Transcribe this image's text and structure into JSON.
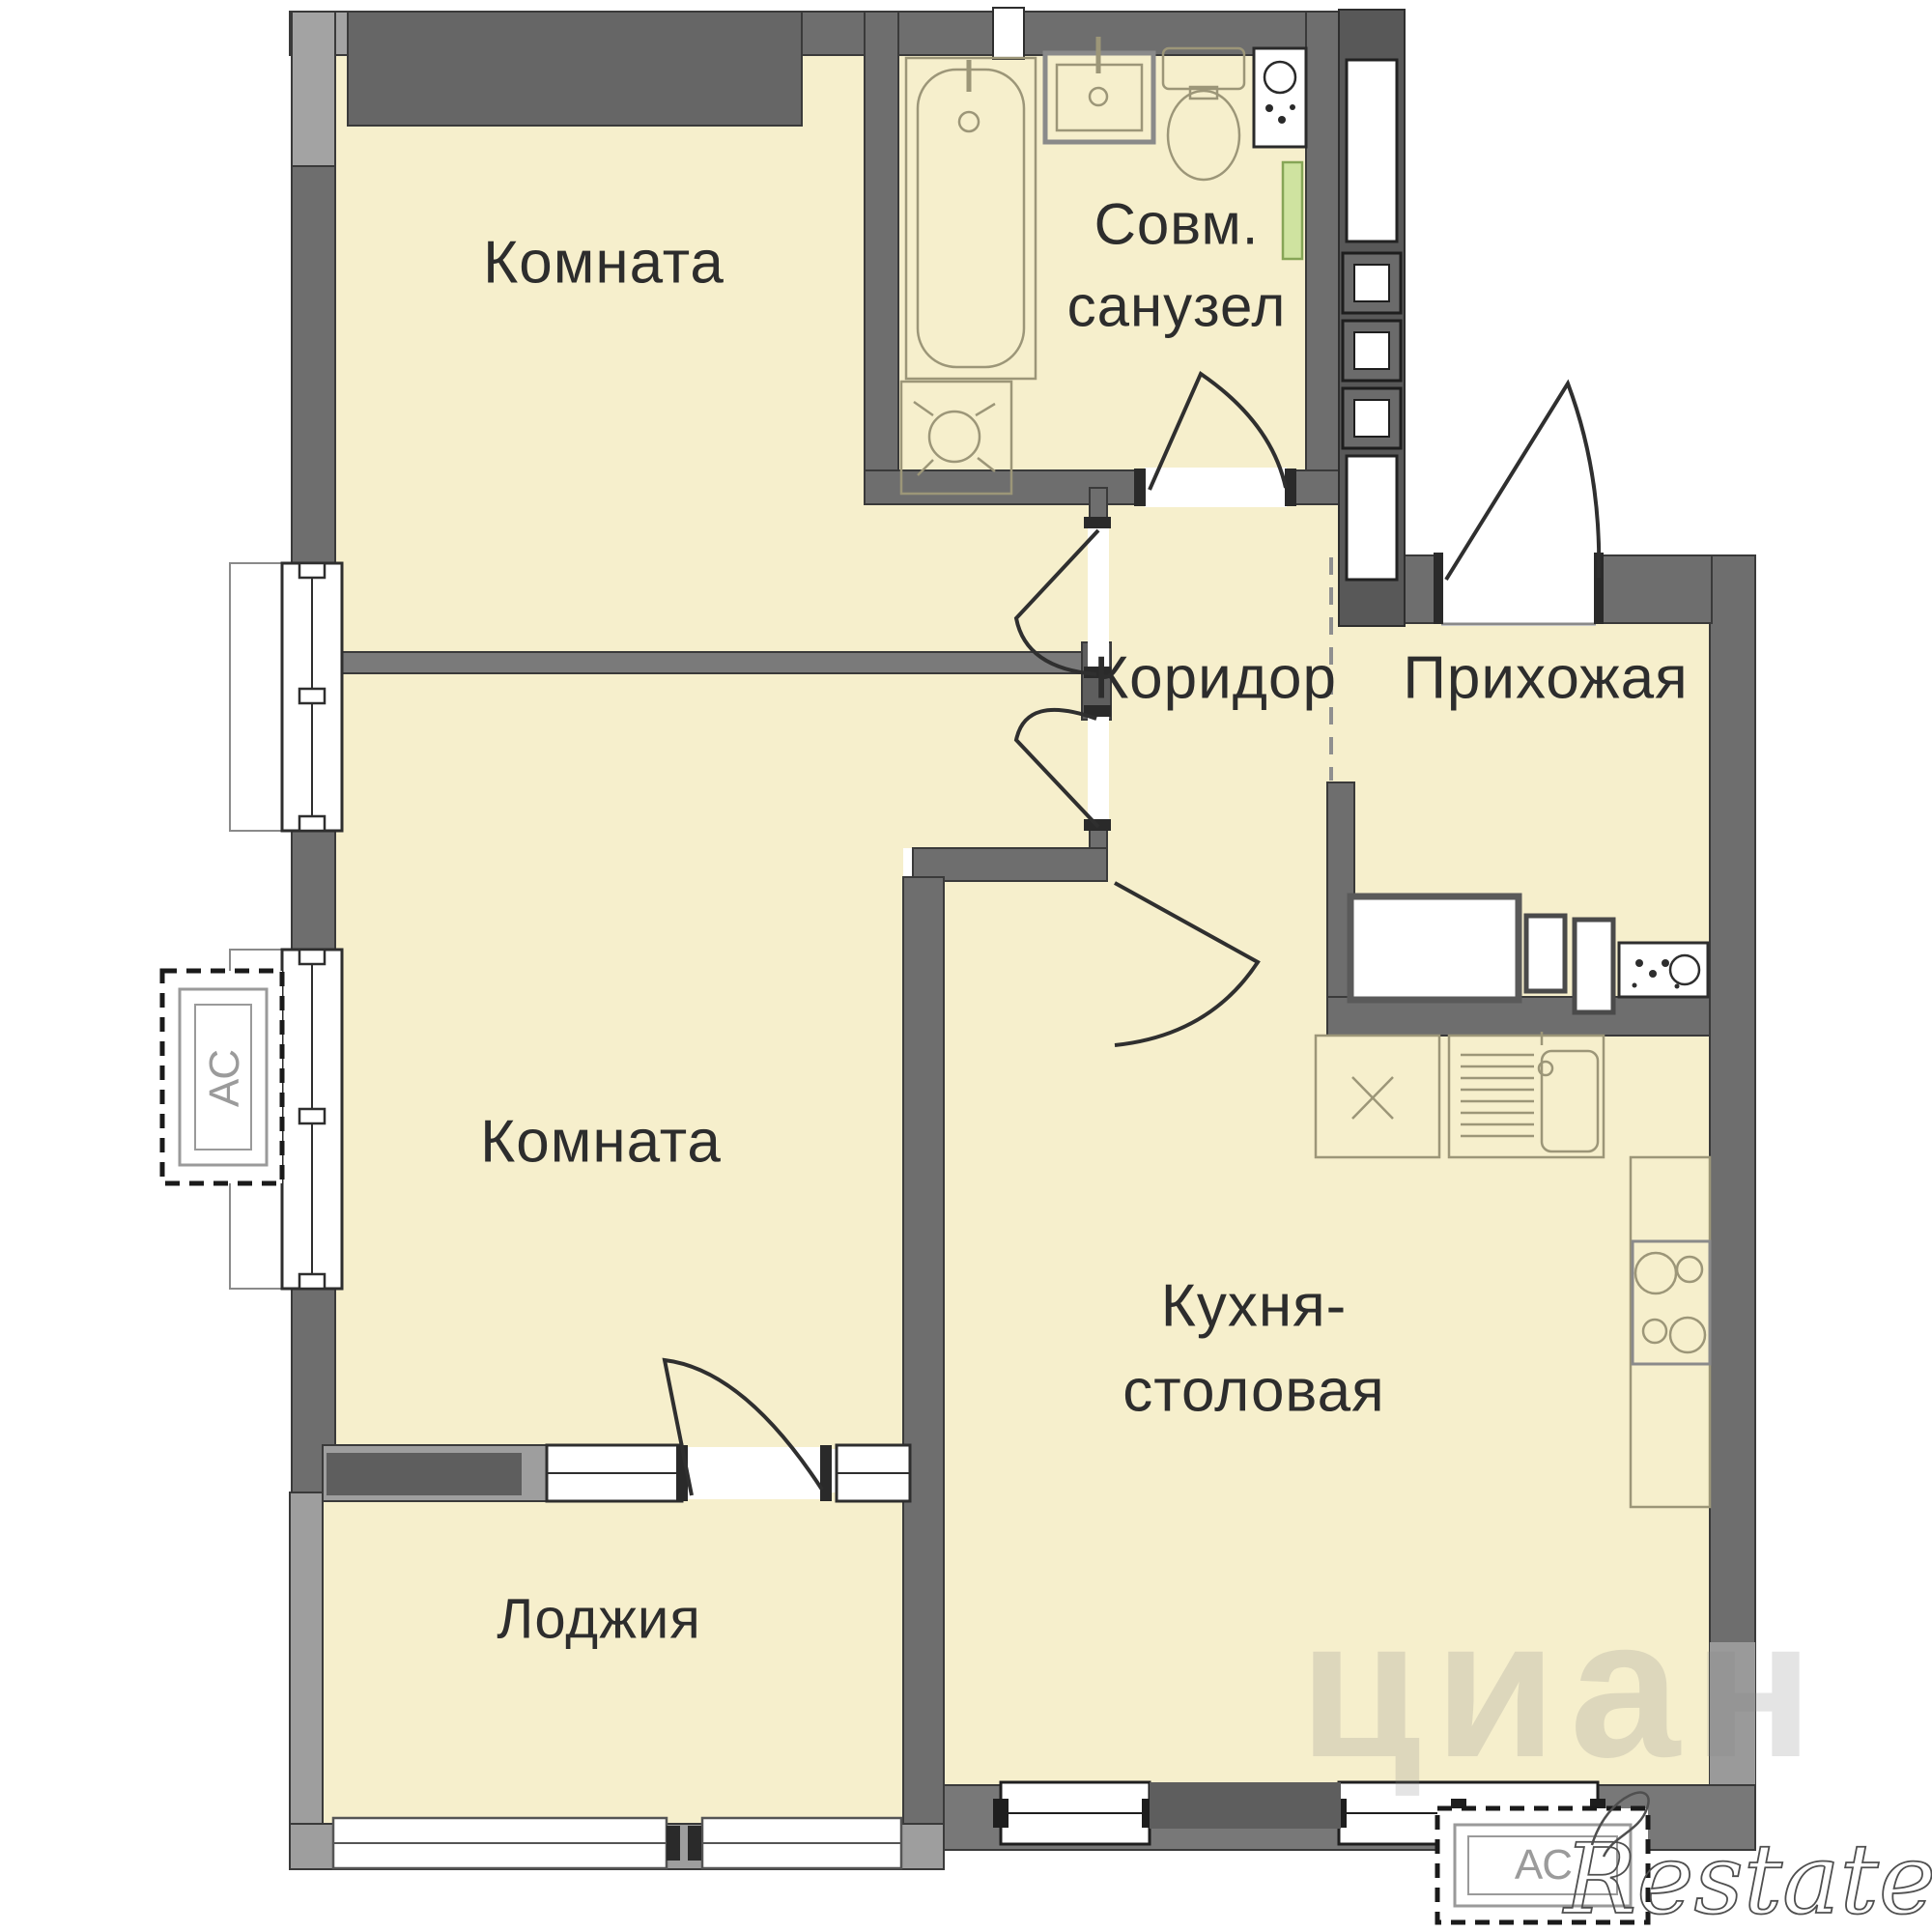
{
  "plan": {
    "type": "apartment-floor-plan",
    "rooms": {
      "room_top": {
        "label": "Комната"
      },
      "bathroom": {
        "label_line1": "Совм.",
        "label_line2": "санузел"
      },
      "corridor": {
        "label": "Коридор"
      },
      "hallway": {
        "label": "Прихожая"
      },
      "room_bottom": {
        "label": "Комната"
      },
      "kitchen": {
        "label_line1": "Кухня-",
        "label_line2": "столовая"
      },
      "loggia": {
        "label": "Лоджия"
      }
    },
    "ac_units": {
      "left": {
        "label": "АС"
      },
      "bottom": {
        "label": "АС"
      }
    },
    "watermarks": {
      "cian": "циан",
      "restate": "Restate"
    },
    "fixtures": [
      "bathtub",
      "bath-sink",
      "toilet",
      "water-heater",
      "washing-machine",
      "green-strip",
      "vent-shaft",
      "wardrobe",
      "appliance-panel",
      "kitchen-cabinet-x",
      "kitchen-sink",
      "stove",
      "radiator",
      "window",
      "door-arc"
    ],
    "colors": {
      "room_fill": "#f6efcc",
      "wall_dark": "#6e6e6e",
      "wall_darker": "#5e5e5e",
      "wall_light": "#a3a3a3",
      "wall_outline": "#3a3a3a",
      "fixture_line": "#9c9678",
      "green_strip_fill": "#cfe3a0",
      "green_strip_border": "#86a556",
      "label_color": "#2d2d2d",
      "ac_label_color": "#9b9b9b"
    }
  }
}
